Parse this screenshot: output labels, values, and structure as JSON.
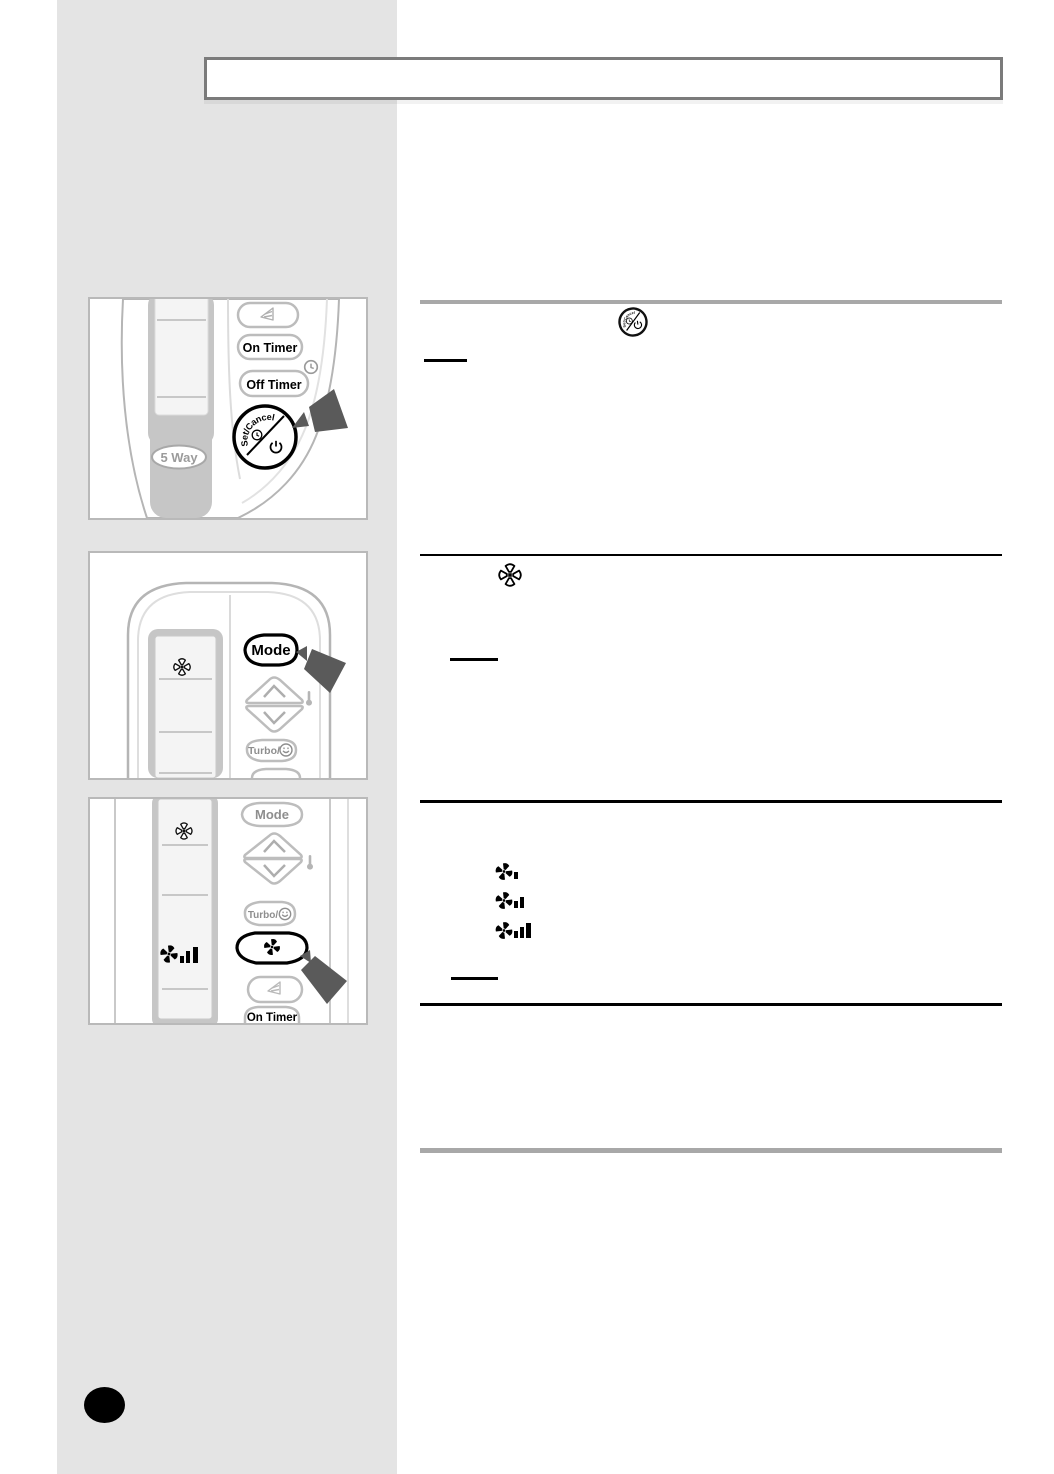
{
  "colors": {
    "sidebar": "#e4e4e4",
    "page_bg": "#ffffff",
    "title_box_border": "#7b7b7b",
    "frame_border": "#b9b9b9",
    "rule_gray": "#a8a8a8",
    "rule_black": "#000000",
    "arrow": "#5a5a5a",
    "page_dot": "#000000",
    "remote_outline": "#b5b5b5",
    "display_shell": "#c6c6c6",
    "display_screen": "#f4f4f4"
  },
  "title_box": {
    "text": ""
  },
  "remote1": {
    "on_timer": "On Timer",
    "off_timer": "Off Timer",
    "set_cancel": "Set/Cancel",
    "five_way": "5 Way"
  },
  "remote2": {
    "mode": "Mode",
    "turbo": "Turbo/"
  },
  "remote3": {
    "mode": "Mode",
    "turbo": "Turbo/",
    "on_timer": "On Timer"
  },
  "sections": [
    {
      "divider": "gray",
      "inline_icon": "set-cancel-button-icon",
      "underline": "short-black-rule"
    },
    {
      "divider": "black",
      "inline_icon": "fan-icon",
      "underline": "short-black-rule"
    },
    {
      "divider": "black",
      "inline_icons": [
        "fan-speed-low-icon",
        "fan-speed-medium-icon",
        "fan-speed-high-icon"
      ],
      "underline": "short-black-rule"
    },
    {
      "divider": "black"
    },
    {
      "divider": "gray"
    }
  ]
}
